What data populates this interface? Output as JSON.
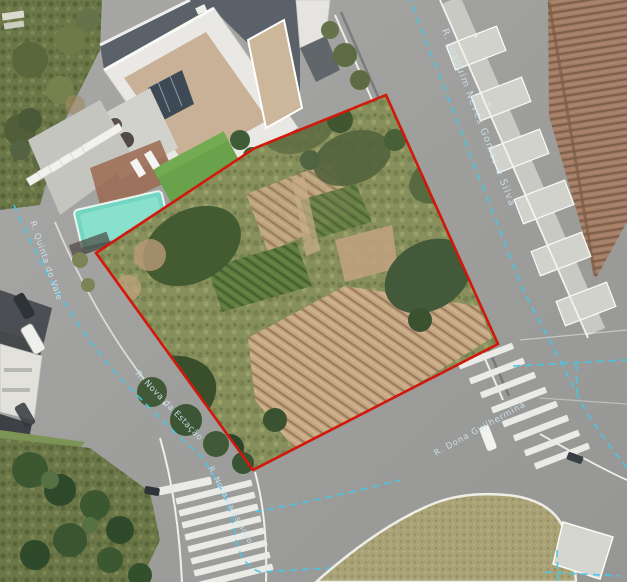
{
  "map": {
    "view_type": "satellite-aerial",
    "overlay": {
      "parcel_outline_color": "#d2180b",
      "road_line_color": "#45c8e9",
      "label_color": "#cde4f0"
    },
    "street_labels": [
      {
        "id": "main-road",
        "text": "R. Joaquim Neves Gomes e Silva"
      },
      {
        "id": "left-road",
        "text": "R. Quinta do Vale"
      },
      {
        "id": "lower-road",
        "text": "R. Nova da Estação"
      },
      {
        "id": "lower-road-south",
        "text": "R. Nova da Estação"
      },
      {
        "id": "cross-road",
        "text": "R. Dona Guilhermina"
      }
    ]
  }
}
